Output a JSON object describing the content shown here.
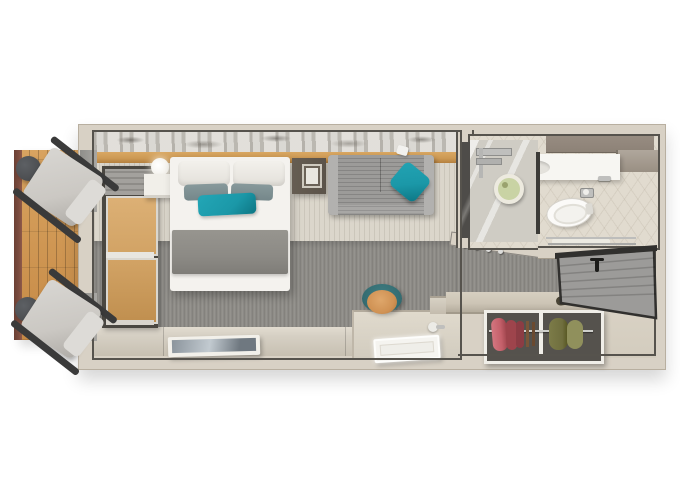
{
  "title": "cruise-stateroom-top-down-floorplan-render",
  "palette": {
    "background": "#ffffff",
    "wall": "#d8d1c5",
    "wall_edge": "#b8afa0",
    "line": "#56534d",
    "wood_ledge": "#cd9a55",
    "deck_rail": "#7b4b3e",
    "carpet_light": "#dbd6cb",
    "carpet_gray": "#8f8d88",
    "floor_beige": "#d6d0c4",
    "bed_white": "#f4f2ee",
    "pillow_gray_teal": "#75878a",
    "teal": "#1b98a8",
    "blanket": "#8c8a85",
    "sofa": "#9c9b99",
    "sofa_arm": "#b2b1af",
    "nightstand_dark": "#5b5349",
    "nightstand_white": "#f1efe9",
    "window_frame": "#4a4741",
    "glass_wood": "#d2a365",
    "valance": "#a3a19d",
    "door": "#9c9b99",
    "door_frame": "#31302e",
    "bath_taupe": "#8d8277",
    "fixture_white": "#f7f6f2",
    "chrome": "#bfbfbd",
    "shower_head_green": "#c9d3a4",
    "mirror_dark": "#4e4c49",
    "closet_interior": "#55524d",
    "closet_frame": "#f0eee8",
    "garment_red": "#c4606a",
    "garment_red_dark": "#9e444c",
    "garment_olive": "#6f6e3e",
    "garment_olive_light": "#90905c",
    "hanger_brown": "#7a5638",
    "bench_wood": "#cdc5b6",
    "stool_orange": "#d09254",
    "stool_teal": "#346c71",
    "chair_cushion": "#cbc8c3",
    "chair_frame": "#3a3a3a",
    "side_table": "#4b4d50",
    "tv_screen_a": "#8b949c",
    "tv_screen_b": "#c2cad0"
  },
  "scene": {
    "balcony": {
      "items": [
        "wood-deck",
        "railing",
        "side-table x2",
        "lounge-chair x2"
      ]
    },
    "bedroom": {
      "items": [
        "wall-art-strip",
        "headboard-wood-ledge",
        "wall-sconce-light",
        "nightstand-left",
        "double-bed",
        "white-pillows x2",
        "gray-teal-cushions x2",
        "teal-accent-pillow",
        "gray-blanket",
        "nightstand-right",
        "framed-art",
        "sofa",
        "teal-throw-pillow",
        "reading-light",
        "balcony-window",
        "roman-blind-valance",
        "light-carpet",
        "gray-carpet",
        "floor-ledge",
        "tv-panel"
      ]
    },
    "desk_area": {
      "items": [
        "vanity-desk",
        "stool-orange-seat",
        "stool-teal-backrest",
        "led-tray",
        "hair-dryer"
      ]
    },
    "entry": {
      "items": [
        "corridor-carpet",
        "coat-hooks-ledge",
        "luggage-bench",
        "shoes x2",
        "wardrobe-two-bays",
        "red-garments",
        "olive-garments",
        "hanging-rail",
        "entry-door",
        "entry-floor"
      ]
    },
    "bathroom": {
      "items": [
        "tile-floor",
        "taupe-wall",
        "vanity-counter",
        "sink-basin",
        "faucet",
        "wall-shelf",
        "shower-glass",
        "shower-mixer",
        "shower-head",
        "glass-divider",
        "mirror-panel",
        "toilet",
        "toilet-paper-holder",
        "towel-rack"
      ]
    }
  }
}
